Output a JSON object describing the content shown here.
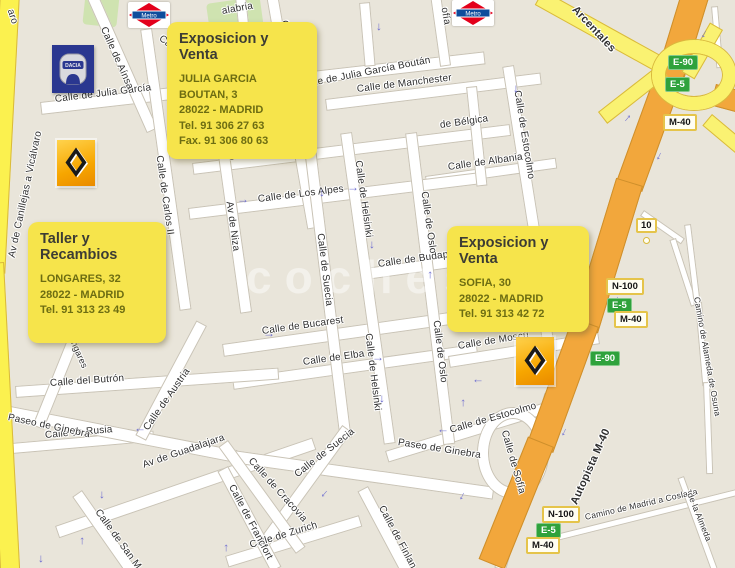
{
  "map": {
    "watermark": "coches",
    "info_boxes": [
      {
        "title": "Exposicion y Venta",
        "lines": [
          "JULIA GARCIA BOUTAN, 3",
          "28022 - MADRID",
          "Tel. 91 306 27 63",
          "Fax. 91 306 80 63"
        ]
      },
      {
        "title": "Taller y Recambios",
        "lines": [
          "LONGARES, 32",
          "28022 - MADRID",
          "Tel. 91 313 23 49"
        ]
      },
      {
        "title": "Exposicion y Venta",
        "lines": [
          "SOFIA, 30",
          "28022 - MADRID",
          "Tel. 91 313 42 72"
        ]
      }
    ],
    "badges": {
      "e90": "E-90",
      "e5": "E-5",
      "m40": "M-40",
      "n100": "N-100",
      "exit": "10"
    },
    "logos": {
      "metro": "Metro",
      "dacia": "DACIA"
    },
    "colors": {
      "background": "#E9E5DA",
      "street": "#FFFFFF",
      "yellow_road": "#FBF14F",
      "highway": "#F2A73C",
      "green_badge": "#2FA23C",
      "info_box": "#F6E44B",
      "arrow": "#6F6FD0",
      "park": "#CFE3B0"
    },
    "street_labels": [
      {
        "text": "Calle de Julia García",
        "x": 55,
        "y": 94,
        "r": -7
      },
      {
        "text": "Calle de Julia García Boután",
        "x": 300,
        "y": 80,
        "r": -11
      },
      {
        "text": "Calle de Manchester",
        "x": 357,
        "y": 84,
        "r": -7
      },
      {
        "text": "Calle de Bélgica",
        "x": 228,
        "y": 152,
        "r": -7
      },
      {
        "text": "de Bélgica",
        "x": 440,
        "y": 120,
        "r": -8
      },
      {
        "text": "Calle de Albania",
        "x": 448,
        "y": 162,
        "r": -8
      },
      {
        "text": "Calle de Los Alpes",
        "x": 258,
        "y": 194,
        "r": -7
      },
      {
        "text": "Calle de Budapest",
        "x": 378,
        "y": 259,
        "r": -8
      },
      {
        "text": "Calle de Bucarest",
        "x": 262,
        "y": 326,
        "r": -8
      },
      {
        "text": "Calle de Elba",
        "x": 303,
        "y": 357,
        "r": -8
      },
      {
        "text": "Calle de Moscú",
        "x": 458,
        "y": 341,
        "r": -9
      },
      {
        "text": "Calle de Estocolmo",
        "x": 450,
        "y": 425,
        "r": -16
      },
      {
        "text": "Calle del Butrón",
        "x": 50,
        "y": 378,
        "r": -4
      },
      {
        "text": "Calle de Rusia",
        "x": 45,
        "y": 430,
        "r": -5
      },
      {
        "text": "Av de Guadalajara",
        "x": 143,
        "y": 460,
        "r": -19
      },
      {
        "text": "Paseo de Ginebra",
        "x": 8,
        "y": 412,
        "r": 12
      },
      {
        "text": "Paseo de Ginebra",
        "x": 398,
        "y": 437,
        "r": 9
      },
      {
        "text": "Calle de Zurich",
        "x": 250,
        "y": 540,
        "r": -17
      },
      {
        "text": "Camino de Madrid a Coslada",
        "x": 585,
        "y": 512,
        "r": -13,
        "s": 8.5
      },
      {
        "text": "Calle de Aínsa",
        "x": 103,
        "y": 22,
        "r": 66
      },
      {
        "text": "Calle de Longares",
        "x": 284,
        "y": 15,
        "r": 80
      },
      {
        "text": "Calle de Ca",
        "x": 160,
        "y": 32,
        "r": 38
      },
      {
        "text": "Calle de Carlos II",
        "x": 159,
        "y": 150,
        "r": 82
      },
      {
        "text": "Av de Niza",
        "x": 229,
        "y": 196,
        "r": 82
      },
      {
        "text": "Calle de Suecia",
        "x": 320,
        "y": 228,
        "r": 83
      },
      {
        "text": "Calle de Suecia",
        "x": 296,
        "y": 470,
        "r": -38
      },
      {
        "text": "Calle de Helsinki",
        "x": 358,
        "y": 155,
        "r": 82
      },
      {
        "text": "Calle de Helsinki",
        "x": 368,
        "y": 328,
        "r": 83
      },
      {
        "text": "Calle de Oslo",
        "x": 424,
        "y": 186,
        "r": 82
      },
      {
        "text": "Calle de Oslo",
        "x": 436,
        "y": 315,
        "r": 83
      },
      {
        "text": "Calle de Estocolmo",
        "x": 517,
        "y": 85,
        "r": 81
      },
      {
        "text": "Calle de Sofía",
        "x": 504,
        "y": 425,
        "r": 74
      },
      {
        "text": "ofía",
        "x": 444,
        "y": 2,
        "r": 80
      },
      {
        "text": "aro",
        "x": 10,
        "y": 4,
        "r": 72
      },
      {
        "text": "alabria",
        "x": 222,
        "y": 6,
        "r": -10
      },
      {
        "text": "Av de Canillejas a Vicálvaro",
        "x": 12,
        "y": 252,
        "r": -78
      },
      {
        "text": "de Longares",
        "x": 64,
        "y": 315,
        "r": 66,
        "s": 9
      },
      {
        "text": "Calle de Austria",
        "x": 146,
        "y": 424,
        "r": -55
      },
      {
        "text": "Calle de Cracovia",
        "x": 250,
        "y": 454,
        "r": 48
      },
      {
        "text": "Calle de Francfort",
        "x": 231,
        "y": 480,
        "r": 62
      },
      {
        "text": "Calle de San M",
        "x": 97,
        "y": 505,
        "r": 54
      },
      {
        "text": "Calle de Finlan",
        "x": 381,
        "y": 501,
        "r": 62
      },
      {
        "text": "Camino de Alameda de Osuna",
        "x": 697,
        "y": 292,
        "r": 80,
        "s": 8.5
      },
      {
        "text": "de la Almeda",
        "x": 690,
        "y": 488,
        "r": 68,
        "s": 8.5
      },
      {
        "text": "Arcentales",
        "x": 574,
        "y": 2,
        "r": 47,
        "s": 11,
        "b": 1
      },
      {
        "text": "Autopista M-40",
        "x": 574,
        "y": 498,
        "r": -66,
        "s": 11,
        "b": 1
      }
    ],
    "arrows": [
      {
        "x": 318,
        "y": 188,
        "r": 90
      },
      {
        "x": 375,
        "y": 22,
        "r": 90
      },
      {
        "x": 446,
        "y": 10,
        "r": -90
      },
      {
        "x": 512,
        "y": 84,
        "r": 90
      },
      {
        "x": 237,
        "y": 194,
        "r": 0
      },
      {
        "x": 347,
        "y": 182,
        "r": 0
      },
      {
        "x": 368,
        "y": 240,
        "r": 90
      },
      {
        "x": 422,
        "y": 270,
        "r": -90
      },
      {
        "x": 378,
        "y": 394,
        "r": 90
      },
      {
        "x": 455,
        "y": 398,
        "r": -90
      },
      {
        "x": 472,
        "y": 378,
        "r": 180
      },
      {
        "x": 437,
        "y": 428,
        "r": 180
      },
      {
        "x": 263,
        "y": 328,
        "r": 0
      },
      {
        "x": 372,
        "y": 352,
        "r": 0
      },
      {
        "x": 134,
        "y": 427,
        "r": 180
      },
      {
        "x": 98,
        "y": 490,
        "r": 90
      },
      {
        "x": 74,
        "y": 536,
        "r": -90
      },
      {
        "x": 37,
        "y": 554,
        "r": 90
      },
      {
        "x": 218,
        "y": 543,
        "r": -90
      },
      {
        "x": 320,
        "y": 490,
        "r": 130
      },
      {
        "x": 458,
        "y": 492,
        "r": 115
      },
      {
        "x": 560,
        "y": 428,
        "r": 115
      },
      {
        "x": 612,
        "y": 296,
        "r": 115
      },
      {
        "x": 655,
        "y": 152,
        "r": 115
      },
      {
        "x": 700,
        "y": 30,
        "r": 115
      },
      {
        "x": 620,
        "y": 112,
        "r": -50
      }
    ]
  }
}
